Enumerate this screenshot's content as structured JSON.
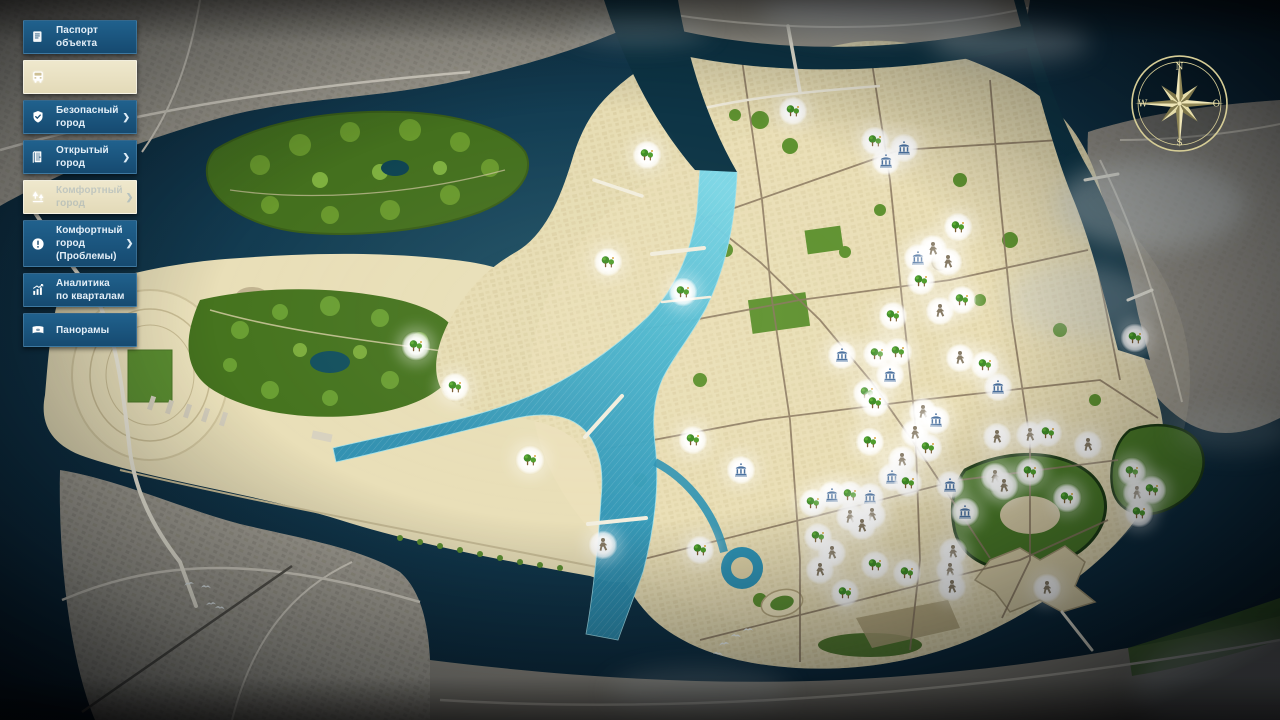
{
  "sidebar": {
    "items": [
      {
        "id": "object-passport",
        "icon": "ic-document",
        "icon_name": "document-icon",
        "lines": [
          "Паспорт объекта"
        ],
        "chevron": false,
        "highlighted": false,
        "faded": false
      },
      {
        "id": "transport",
        "icon": "ic-bus",
        "icon_name": "bus-icon",
        "lines": [
          ""
        ],
        "chevron": false,
        "highlighted": true,
        "faded": false
      },
      {
        "id": "safe-city",
        "icon": "ic-shield",
        "icon_name": "shield-check-icon",
        "lines": [
          "Безопасный город"
        ],
        "chevron": true,
        "highlighted": false,
        "faded": false
      },
      {
        "id": "open-city",
        "icon": "ic-door",
        "icon_name": "open-door-icon",
        "lines": [
          "Открытый город"
        ],
        "chevron": true,
        "highlighted": false,
        "faded": false
      },
      {
        "id": "comfort-city",
        "icon": "ic-trees",
        "icon_name": "trees-icon",
        "lines": [
          "Комфортный город"
        ],
        "chevron": true,
        "highlighted": true,
        "faded": true
      },
      {
        "id": "comfort-city-problems",
        "icon": "ic-alert",
        "icon_name": "alert-icon",
        "lines": [
          "Комфортный город",
          "(Проблемы)"
        ],
        "chevron": true,
        "highlighted": false,
        "faded": false
      },
      {
        "id": "analytics-by-blocks",
        "icon": "ic-chart",
        "icon_name": "bar-chart-icon",
        "lines": [
          "Аналитика",
          "по кварталам"
        ],
        "chevron": false,
        "highlighted": false,
        "faded": false
      },
      {
        "id": "panoramas",
        "icon": "ic-panorama",
        "icon_name": "panorama-icon",
        "lines": [
          "Панорамы"
        ],
        "chevron": false,
        "highlighted": false,
        "faded": false
      }
    ]
  },
  "compass": {
    "north": "N",
    "west": "W",
    "east": "O",
    "south": "S"
  },
  "map": {
    "colors": {
      "sidebar_blue": "#1b5078",
      "highlight_beige": "#e9e1c3",
      "water_dark": "#0e3044",
      "river_cyan": "#45b4cf",
      "land_beige": "#e7ddb4",
      "land_gray": "#a29e93",
      "park_green": "#4a7a26",
      "marker_tree": "#3e8c26",
      "marker_person": "#867a64",
      "marker_pavilion": "#49709f",
      "compass_gold": "#d6cd96"
    },
    "marker_types": [
      "tree",
      "person",
      "pavilion"
    ],
    "markers": [
      {
        "x": 793,
        "y": 111,
        "t": "tree"
      },
      {
        "x": 875,
        "y": 141,
        "t": "tree"
      },
      {
        "x": 886,
        "y": 161,
        "t": "pavilion"
      },
      {
        "x": 904,
        "y": 148,
        "t": "pavilion"
      },
      {
        "x": 647,
        "y": 155,
        "t": "tree"
      },
      {
        "x": 918,
        "y": 258,
        "t": "pavilion"
      },
      {
        "x": 933,
        "y": 249,
        "t": "person"
      },
      {
        "x": 948,
        "y": 262,
        "t": "person"
      },
      {
        "x": 921,
        "y": 281,
        "t": "tree"
      },
      {
        "x": 958,
        "y": 227,
        "t": "tree"
      },
      {
        "x": 962,
        "y": 300,
        "t": "tree"
      },
      {
        "x": 940,
        "y": 311,
        "t": "person"
      },
      {
        "x": 893,
        "y": 316,
        "t": "tree"
      },
      {
        "x": 608,
        "y": 262,
        "t": "tree"
      },
      {
        "x": 683,
        "y": 292,
        "t": "tree"
      },
      {
        "x": 416,
        "y": 346,
        "t": "tree"
      },
      {
        "x": 455,
        "y": 387,
        "t": "tree"
      },
      {
        "x": 530,
        "y": 460,
        "t": "tree"
      },
      {
        "x": 842,
        "y": 355,
        "t": "pavilion"
      },
      {
        "x": 877,
        "y": 354,
        "t": "tree"
      },
      {
        "x": 898,
        "y": 352,
        "t": "tree"
      },
      {
        "x": 960,
        "y": 358,
        "t": "person"
      },
      {
        "x": 985,
        "y": 365,
        "t": "tree"
      },
      {
        "x": 890,
        "y": 375,
        "t": "pavilion"
      },
      {
        "x": 998,
        "y": 387,
        "t": "pavilion"
      },
      {
        "x": 867,
        "y": 393,
        "t": "tree"
      },
      {
        "x": 875,
        "y": 403,
        "t": "tree"
      },
      {
        "x": 923,
        "y": 412,
        "t": "person"
      },
      {
        "x": 936,
        "y": 420,
        "t": "pavilion"
      },
      {
        "x": 915,
        "y": 433,
        "t": "person"
      },
      {
        "x": 997,
        "y": 437,
        "t": "person"
      },
      {
        "x": 870,
        "y": 442,
        "t": "tree"
      },
      {
        "x": 928,
        "y": 448,
        "t": "tree"
      },
      {
        "x": 902,
        "y": 460,
        "t": "person"
      },
      {
        "x": 892,
        "y": 477,
        "t": "pavilion"
      },
      {
        "x": 908,
        "y": 483,
        "t": "tree"
      },
      {
        "x": 950,
        "y": 485,
        "t": "pavilion"
      },
      {
        "x": 995,
        "y": 477,
        "t": "person"
      },
      {
        "x": 1004,
        "y": 486,
        "t": "person"
      },
      {
        "x": 1135,
        "y": 338,
        "t": "tree"
      },
      {
        "x": 1030,
        "y": 435,
        "t": "person"
      },
      {
        "x": 1048,
        "y": 433,
        "t": "tree"
      },
      {
        "x": 1088,
        "y": 445,
        "t": "person"
      },
      {
        "x": 1030,
        "y": 472,
        "t": "tree"
      },
      {
        "x": 1132,
        "y": 472,
        "t": "tree"
      },
      {
        "x": 1067,
        "y": 498,
        "t": "tree"
      },
      {
        "x": 1137,
        "y": 493,
        "t": "person"
      },
      {
        "x": 1152,
        "y": 490,
        "t": "tree"
      },
      {
        "x": 1139,
        "y": 513,
        "t": "tree"
      },
      {
        "x": 813,
        "y": 503,
        "t": "tree"
      },
      {
        "x": 832,
        "y": 495,
        "t": "pavilion"
      },
      {
        "x": 850,
        "y": 495,
        "t": "tree"
      },
      {
        "x": 870,
        "y": 497,
        "t": "pavilion"
      },
      {
        "x": 850,
        "y": 517,
        "t": "person"
      },
      {
        "x": 872,
        "y": 515,
        "t": "person"
      },
      {
        "x": 862,
        "y": 526,
        "t": "person"
      },
      {
        "x": 818,
        "y": 537,
        "t": "tree"
      },
      {
        "x": 832,
        "y": 553,
        "t": "person"
      },
      {
        "x": 820,
        "y": 570,
        "t": "person"
      },
      {
        "x": 875,
        "y": 565,
        "t": "tree"
      },
      {
        "x": 907,
        "y": 573,
        "t": "tree"
      },
      {
        "x": 965,
        "y": 512,
        "t": "pavilion"
      },
      {
        "x": 953,
        "y": 552,
        "t": "person"
      },
      {
        "x": 950,
        "y": 570,
        "t": "person"
      },
      {
        "x": 952,
        "y": 587,
        "t": "person"
      },
      {
        "x": 845,
        "y": 593,
        "t": "tree"
      },
      {
        "x": 1047,
        "y": 588,
        "t": "person"
      },
      {
        "x": 693,
        "y": 440,
        "t": "tree"
      },
      {
        "x": 741,
        "y": 470,
        "t": "pavilion"
      },
      {
        "x": 700,
        "y": 550,
        "t": "tree"
      },
      {
        "x": 603,
        "y": 545,
        "t": "person"
      }
    ],
    "birds": [
      {
        "x": 183,
        "y": 580,
        "r": -10
      },
      {
        "x": 200,
        "y": 583,
        "r": 5
      },
      {
        "x": 205,
        "y": 600,
        "r": -5
      },
      {
        "x": 214,
        "y": 604,
        "r": 8
      },
      {
        "x": 718,
        "y": 640,
        "r": -8
      },
      {
        "x": 730,
        "y": 632,
        "r": 6
      },
      {
        "x": 742,
        "y": 626,
        "r": -4
      },
      {
        "x": 712,
        "y": 650,
        "r": 10
      }
    ]
  }
}
